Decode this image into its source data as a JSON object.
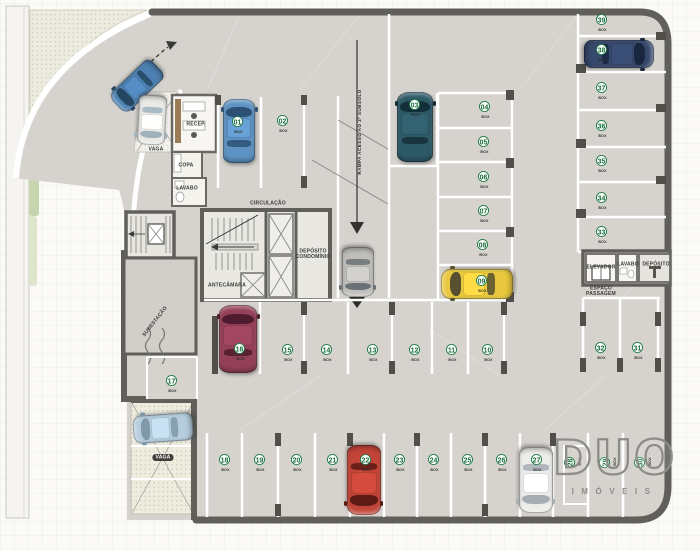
{
  "logo": {
    "brand": "DUO",
    "tagline": "IMÓVEIS"
  },
  "labels": [
    {
      "name": "label-recepcao",
      "text": "RECEP.",
      "cx": 196,
      "cy": 122
    },
    {
      "name": "label-copa",
      "text": "COPA",
      "cx": 186,
      "cy": 163
    },
    {
      "name": "label-lavabo-left",
      "text": "LAVABO",
      "cx": 187,
      "cy": 186
    },
    {
      "name": "label-circulacao",
      "text": "CIRCULAÇÃO",
      "cx": 268,
      "cy": 201
    },
    {
      "name": "label-deposito-condominio",
      "text": "DEPÓSITO\nCONDOMÍNIO",
      "cx": 313,
      "cy": 255
    },
    {
      "name": "label-antecamara",
      "text": "ANTECÂMARA",
      "cx": 227,
      "cy": 283
    },
    {
      "name": "label-subestacao",
      "text": "SUBESTAÇÃO",
      "cx": 153,
      "cy": 320,
      "rot": -52
    },
    {
      "name": "label-elevador",
      "text": "ELEVADOR",
      "cx": 601,
      "cy": 265
    },
    {
      "name": "label-lavabo-right",
      "text": "LAVABO",
      "cx": 628,
      "cy": 262
    },
    {
      "name": "label-deposito",
      "text": "DEPÓSITO",
      "cx": 656,
      "cy": 262
    },
    {
      "name": "label-espaco-passagem",
      "text": "ESPAÇO\nPASSAGEM",
      "cx": 601,
      "cy": 292
    },
    {
      "name": "label-vaga-top",
      "text": "VAGA",
      "cx": 156,
      "cy": 147
    },
    {
      "name": "label-vaga-bottom",
      "text": "VAGA",
      "cx": 163,
      "cy": 455,
      "cls": "pill"
    },
    {
      "name": "label-rampa",
      "text": "RAMPA ACESSO AO 2º SUBSOLO",
      "cx": 357,
      "cy": 132,
      "rot": -90,
      "cls": "ramp"
    }
  ],
  "spots": [
    {
      "num": "01",
      "box": "BOX",
      "cx": 238,
      "cy": 124
    },
    {
      "num": "02",
      "box": "BOX",
      "cx": 283,
      "cy": 123
    },
    {
      "num": "03",
      "box": "BOX",
      "cx": 415,
      "cy": 107
    },
    {
      "num": "04",
      "box": "BOX",
      "cx": 485,
      "cy": 109
    },
    {
      "num": "05",
      "box": "BOX",
      "cx": 484,
      "cy": 144
    },
    {
      "num": "06",
      "box": "BOX",
      "cx": 484,
      "cy": 179
    },
    {
      "num": "07",
      "box": "BOX",
      "cx": 484,
      "cy": 213
    },
    {
      "num": "08",
      "box": "BOX",
      "cx": 483,
      "cy": 247
    },
    {
      "num": "09",
      "box": "BOX",
      "cx": 482,
      "cy": 283
    },
    {
      "num": "10",
      "box": "BOX",
      "cx": 488,
      "cy": 352
    },
    {
      "num": "11",
      "box": "BOX",
      "cx": 452,
      "cy": 352
    },
    {
      "num": "12",
      "box": "BOX",
      "cx": 415,
      "cy": 352
    },
    {
      "num": "13",
      "box": "BOX",
      "cx": 373,
      "cy": 352
    },
    {
      "num": "14",
      "box": "BOX",
      "cx": 327,
      "cy": 352
    },
    {
      "num": "15",
      "box": "BOX",
      "cx": 288,
      "cy": 352
    },
    {
      "num": "16",
      "box": "BOX",
      "cx": 240,
      "cy": 351
    },
    {
      "num": "17",
      "box": "BOX",
      "cx": 172,
      "cy": 383
    },
    {
      "num": "18",
      "box": "BOX",
      "cx": 225,
      "cy": 462
    },
    {
      "num": "19",
      "box": "BOX",
      "cx": 260,
      "cy": 462
    },
    {
      "num": "20",
      "box": "BOX",
      "cx": 297,
      "cy": 462
    },
    {
      "num": "21",
      "box": "BOX",
      "cx": 333,
      "cy": 462
    },
    {
      "num": "22",
      "box": "BOX",
      "cx": 366,
      "cy": 462
    },
    {
      "num": "23",
      "box": "BOX",
      "cx": 400,
      "cy": 462
    },
    {
      "num": "24",
      "box": "BOX",
      "cx": 434,
      "cy": 462
    },
    {
      "num": "25",
      "box": "BOX",
      "cx": 468,
      "cy": 462
    },
    {
      "num": "26",
      "box": "BOX",
      "cx": 502,
      "cy": 462
    },
    {
      "num": "27",
      "box": "BOX",
      "cx": 537,
      "cy": 462
    },
    {
      "num": "28",
      "box": "BOX",
      "cx": 572,
      "cy": 462,
      "rot": -90
    },
    {
      "num": "29",
      "box": "BOX",
      "cx": 607,
      "cy": 462,
      "rot": -90
    },
    {
      "num": "30",
      "box": "BOX",
      "cx": 642,
      "cy": 462,
      "rot": -90
    },
    {
      "num": "31",
      "box": "BOX",
      "cx": 638,
      "cy": 350
    },
    {
      "num": "32",
      "box": "BOX",
      "cx": 601,
      "cy": 350
    },
    {
      "num": "33",
      "box": "BOX",
      "cx": 602,
      "cy": 234
    },
    {
      "num": "34",
      "box": "BOX",
      "cx": 602,
      "cy": 200
    },
    {
      "num": "35",
      "box": "BOX",
      "cx": 602,
      "cy": 163
    },
    {
      "num": "36",
      "box": "BOX",
      "cx": 602,
      "cy": 128
    },
    {
      "num": "37",
      "box": "BOX",
      "cx": 602,
      "cy": 90
    },
    {
      "num": "38",
      "box": "BOX",
      "cx": 602,
      "cy": 52
    },
    {
      "num": "39",
      "box": "BOX",
      "cx": 602,
      "cy": 22
    }
  ],
  "cars": [
    {
      "name": "car-entry-drive",
      "cx": 137,
      "cy": 86,
      "w": 26,
      "h": 56,
      "rot": 226,
      "body": "#4d80b2",
      "glass": "#254661"
    },
    {
      "name": "car-vaga-top",
      "cx": 152,
      "cy": 120,
      "w": 28,
      "h": 50,
      "rot": 183,
      "body": "#e9e9e6",
      "glass": "#9fb2bb"
    },
    {
      "name": "car-spot-01",
      "cx": 239,
      "cy": 131,
      "w": 32,
      "h": 64,
      "rot": 0,
      "body": "#5e92c2",
      "glass": "#2c5174"
    },
    {
      "name": "car-spot-03",
      "cx": 415,
      "cy": 127,
      "w": 36,
      "h": 70,
      "rot": 0,
      "body": "#2e5a68",
      "glass": "#132e38"
    },
    {
      "name": "car-spot-38",
      "cx": 619,
      "cy": 54,
      "w": 28,
      "h": 70,
      "rot": 90,
      "body": "#36486b",
      "glass": "#18263e"
    },
    {
      "name": "car-spot-09",
      "cx": 477,
      "cy": 284,
      "w": 30,
      "h": 72,
      "rot": -90,
      "body": "#e9c83f",
      "glass": "#57502f"
    },
    {
      "name": "car-ramp-down",
      "cx": 358,
      "cy": 272,
      "w": 32,
      "h": 50,
      "rot": 180,
      "body": "#bfbebb",
      "glass": "#6b7276"
    },
    {
      "name": "car-spot-16",
      "cx": 238,
      "cy": 339,
      "w": 38,
      "h": 68,
      "rot": 0,
      "body": "#944059",
      "glass": "#4e1c2e"
    },
    {
      "name": "car-spot-22",
      "cx": 364,
      "cy": 480,
      "w": 34,
      "h": 70,
      "rot": 180,
      "body": "#c24437",
      "glass": "#5c1b14"
    },
    {
      "name": "car-spot-27",
      "cx": 536,
      "cy": 480,
      "w": 34,
      "h": 66,
      "rot": 180,
      "body": "#ececea",
      "glass": "#a6adb3"
    },
    {
      "name": "car-vaga-bottom",
      "cx": 163,
      "cy": 428,
      "w": 28,
      "h": 60,
      "rot": 266,
      "body": "#b6cdde",
      "glass": "#8099aa"
    }
  ]
}
